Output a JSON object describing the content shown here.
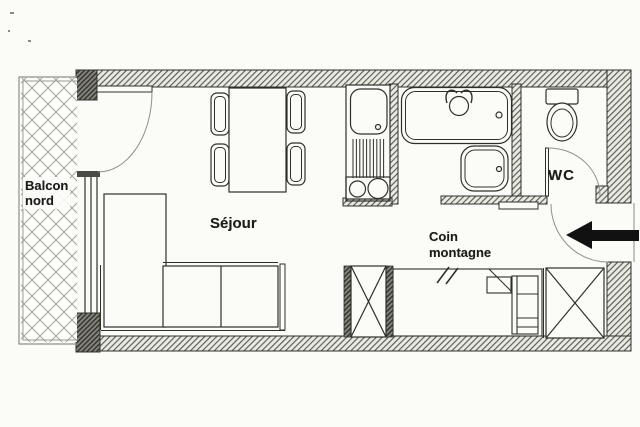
{
  "document": {
    "kind": "apartment floor plan"
  },
  "labels": {
    "balcony_line1": "Balcon",
    "balcony_line2": "nord",
    "living_room": "Séjour",
    "nook_line1": "Coin",
    "nook_line2": "montagne",
    "wc": "WC"
  },
  "icons": {
    "entrance_arrow": "arrow-left"
  },
  "colors": {
    "background": "#fbfbf8",
    "line": "#2f2f2a",
    "wall_hatch": "#57574f",
    "door_arc": "#90908a",
    "arrow": "#111111",
    "text": "#1b1b18"
  }
}
